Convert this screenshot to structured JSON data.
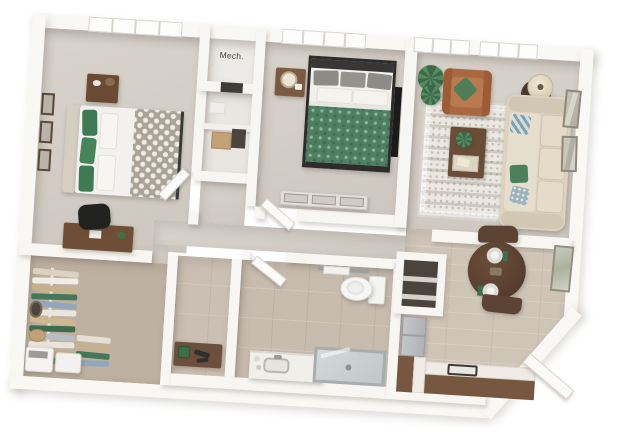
{
  "scene": {
    "type": "3d-apartment-floor-plan-render",
    "view": "top-down dollhouse view, one-bedroom-plus-den apartment",
    "background": "#ffffff"
  },
  "labels": {
    "mech": "Mech."
  },
  "palette": {
    "wall": "#f8f6f2",
    "carpet": "#d3cec7",
    "bath_tile": "#c8bcae",
    "dining_tile": "#cfc5b7",
    "closet_floor": "#beb1a1",
    "cabinet_brown": "#77573f",
    "furniture_brown": "#6b4a33",
    "dark_wood": "#5d4334",
    "accent_green": "#4c7f5b",
    "sofa_beige": "#dcd2bf",
    "leather_chair": "#aa6840",
    "bedding_white": "#f3f1ed",
    "metal_gray": "#b9bdbf"
  },
  "closet": {
    "clothes_colors": [
      "#dcd2bf",
      "#f0ede7",
      "#c7b18a",
      "#47775a",
      "#92a6b7",
      "#eae6dd",
      "#cdb892",
      "#3f6b4e",
      "#b9bec5",
      "#e9e3d8",
      "#c7b18a",
      "#6d9079"
    ],
    "clothes_colors_small": [
      "#e6e0d4",
      "#c7b18a",
      "#47775a",
      "#93a7b8"
    ]
  },
  "rooms": [
    {
      "id": "bedroom-1",
      "furniture": [
        "upholstered bed, green pillows, gray quatrefoil throw",
        "nightstand with decor",
        "three wall frames",
        "desk with black office chair",
        "window"
      ]
    },
    {
      "id": "walk-in-closet",
      "furniture": [
        "hanging clothes rack",
        "round wall mirror",
        "basket",
        "two laundry units with towel"
      ]
    },
    {
      "id": "mech-closet",
      "label": "Mech."
    },
    {
      "id": "storage-closet",
      "furniture": [
        "shelf",
        "tan box",
        "dark box"
      ]
    },
    {
      "id": "bedroom-2",
      "furniture": [
        "dark-frame bed, green duvet, gray pillows",
        "nightstand with lamp",
        "low dresser",
        "wall tv",
        "window"
      ]
    },
    {
      "id": "living-room",
      "furniture": [
        "beige sofa with green and blue pillows",
        "caramel leather armchair",
        "round side table with lamp",
        "patterned area rug",
        "coffee table with plant and tray",
        "potted plant",
        "two wall frames",
        "two windows"
      ]
    },
    {
      "id": "bathroom",
      "furniture": [
        "toilet",
        "vanity with sink",
        "walk-in glass shower",
        "towel bar",
        "door"
      ]
    },
    {
      "id": "dressing-nook",
      "furniture": [
        "console with plant and accessories"
      ]
    },
    {
      "id": "kitchen-dining",
      "furniture": [
        "round dining table, two place settings with green napkins",
        "two chairs",
        "pantry with shelves",
        "refrigerator",
        "L-shaped counter with sink",
        "wall art",
        "angled entry with open door"
      ]
    }
  ]
}
